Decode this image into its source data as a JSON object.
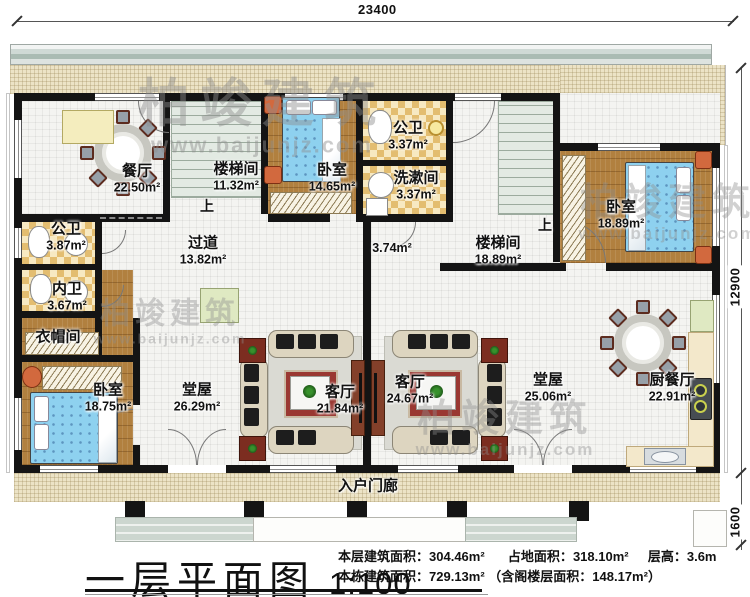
{
  "watermark": {
    "brand": "柏竣建筑",
    "site": "www.baijunjz.com"
  },
  "dimensions": {
    "width_top": "23400",
    "height_main": "12900",
    "height_porch": "1600"
  },
  "stairs": {
    "up": "上"
  },
  "rooms": {
    "dining": {
      "name": "餐厅",
      "area": "22.50m²"
    },
    "stair1": {
      "name": "楼梯间",
      "area": "11.32m²"
    },
    "bedroom_top": {
      "name": "卧室",
      "area": "14.65m²"
    },
    "bath_top": {
      "name": "公卫",
      "area": "3.37m²"
    },
    "washroom": {
      "name": "洗漱间",
      "area": "3.37m²"
    },
    "bedroom_right": {
      "name": "卧室",
      "area": "18.89m²"
    },
    "stair2": {
      "name": "楼梯间",
      "area": "18.89m²"
    },
    "nook": {
      "area": "3.74m²"
    },
    "corridor": {
      "name": "过道",
      "area": "13.82m²"
    },
    "bath_left": {
      "name": "公卫",
      "area": "3.87m²"
    },
    "bath_inner": {
      "name": "内卫",
      "area": "3.67m²"
    },
    "cloakroom": {
      "name": "衣帽间"
    },
    "bedroom_left": {
      "name": "卧室",
      "area": "18.75m²"
    },
    "hall_left": {
      "name": "堂屋",
      "area": "26.29m²"
    },
    "living_left": {
      "name": "客厅",
      "area": "21.84m²"
    },
    "living_right": {
      "name": "客厅",
      "area": "24.67m²"
    },
    "hall_right": {
      "name": "堂屋",
      "area": "25.06m²"
    },
    "kitchen_dining": {
      "name": "厨餐厅",
      "area": "22.91m²"
    },
    "porch": {
      "name": "入户门廊"
    }
  },
  "title_block": {
    "title": "一层平面图",
    "scale": "1:100",
    "stats": {
      "floor_area_label": "本层建筑面积：",
      "floor_area_value": "304.46m²",
      "land_area_label": "占地面积：",
      "land_area_value": "318.10m²",
      "storey_height_label": "层高：",
      "storey_height_value": "3.6m",
      "total_area_label": "本栋建筑面积：",
      "total_area_value": "729.13m²",
      "attic_area_note": "（含阁楼层面积：148.17m²）"
    }
  },
  "colors": {
    "wall": "#141414",
    "wood_floor": "#b1803f",
    "checker_tile": "#e3bd70",
    "terrace": "#ece3c6",
    "bed": "#8ed1ef",
    "rug": "#9a3832",
    "roof_band": "#b9c8c2"
  }
}
